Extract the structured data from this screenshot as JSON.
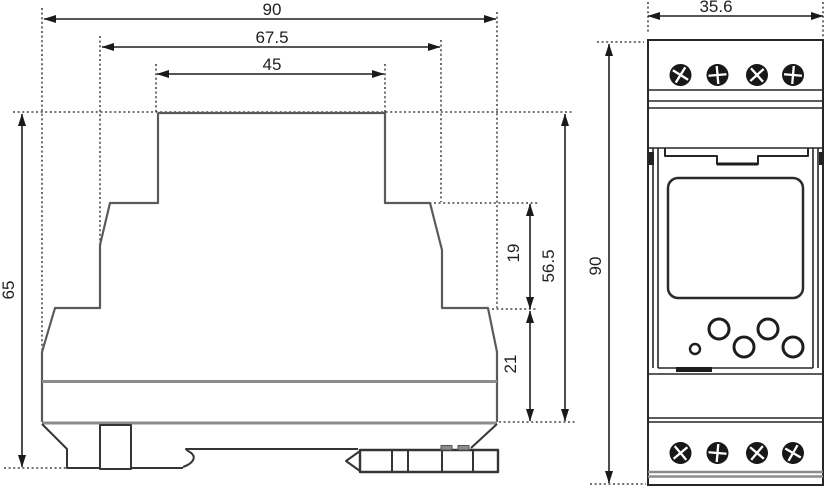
{
  "side_view": {
    "dim_overall_width": "90",
    "dim_mid_width": "67.5",
    "dim_top_width": "45",
    "dim_height": "65",
    "dim_step_upper": "19",
    "dim_step_lower": "21",
    "dim_right_height": "56.5"
  },
  "front_view": {
    "dim_width": "35.6",
    "dim_height": "90"
  },
  "colors": {
    "dimension_lines": "#1f1f1f",
    "body_outline": "#5a5a5a",
    "grey_bands": "#8c8c8c",
    "background": "#ffffff"
  }
}
